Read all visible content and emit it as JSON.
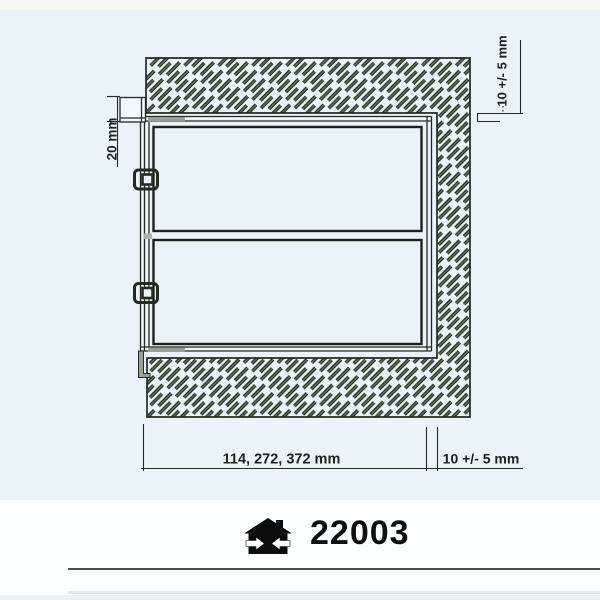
{
  "drawing": {
    "dim_frame_overhang": "20 mm",
    "dim_top_gap": "10 +/- 5 mm",
    "dim_module_widths": "114, 272, 372 mm",
    "dim_side_gap": "10 +/- 5 mm",
    "colors": {
      "background": "#e9f3f8",
      "top_strip": "#f3f9f2",
      "footer_band": "#fbfdfe",
      "linework": "#232a22",
      "hatch_fill": "#5d7156",
      "seal_gray": "#97a197"
    }
  },
  "footer": {
    "product_code": "22003",
    "icon": "house-width-arrows-icon",
    "rule_dark_color": "#4b5154",
    "rule_light_color": "#dde9ee"
  }
}
